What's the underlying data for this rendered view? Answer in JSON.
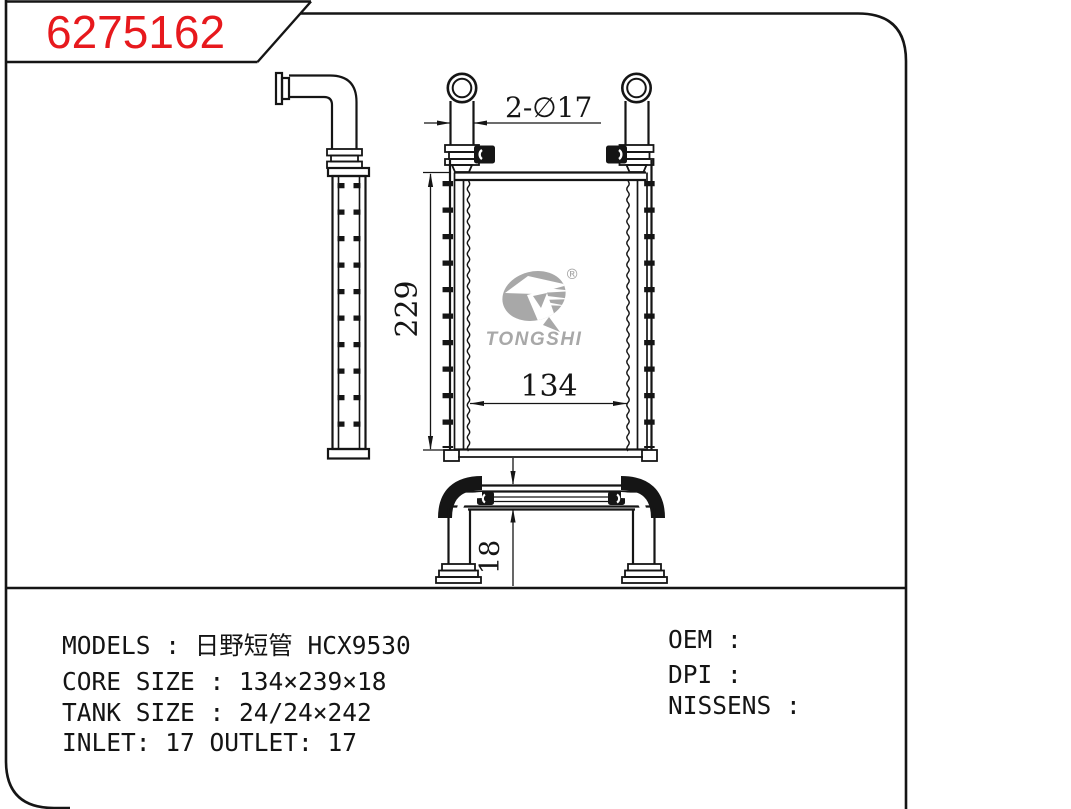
{
  "title_block": {
    "part_number": "6275162"
  },
  "drawing": {
    "dimensions": {
      "ports": "2-∅17",
      "height": "229",
      "width": "134",
      "depth": "18"
    },
    "logo": {
      "name": "TONGSHI",
      "registered": "®"
    }
  },
  "specs": {
    "models": "MODELS : 日野短管 HCX9530",
    "core_size": "CORE SIZE : 134×239×18",
    "tank_size": "TANK SIZE : 24/24×242",
    "inlet_outlet": "INLET: 17  OUTLET: 17",
    "oem": "OEM :",
    "dpi": "DPI :",
    "nissens": "NISSENS :"
  },
  "colors": {
    "accent_red": "#e7191d",
    "logo_gray": "#a8a8a8",
    "line_black": "#151515"
  }
}
